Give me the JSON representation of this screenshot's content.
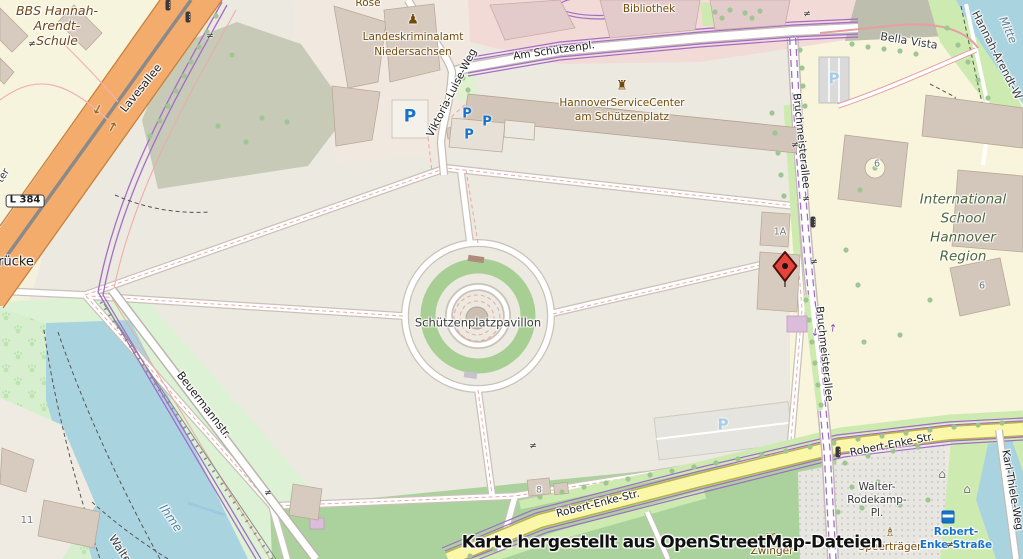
{
  "map": {
    "attribution": "Karte hergestellt aus OpenStreetMap-Dateien",
    "marker": {
      "x": 785,
      "y": 266
    },
    "colors": {
      "water": "#AAD3E0",
      "grass": "#CDEBB0",
      "park": "#DDF2D5",
      "road_orange": "#F4AC6C",
      "road_yellow": "#FBF7A9",
      "tram_purple": "#A46CC8",
      "marker_red": "#E8433A",
      "parking_blue": "#1673C9",
      "poi_brown": "#734A08"
    },
    "labels": [
      {
        "n": "poi-label-rose",
        "t": "Rose",
        "x": 368,
        "y": 3,
        "s": 10.5,
        "c": "poi"
      },
      {
        "n": "school-label-bbs-line1",
        "t": "BBS Hannah-",
        "x": 57,
        "y": 11,
        "s": 12.5,
        "c": "poi-i"
      },
      {
        "n": "school-label-bbs-line2",
        "t": "Arendt-",
        "x": 57,
        "y": 26,
        "s": 12.5,
        "c": "poi-i"
      },
      {
        "n": "school-label-bbs-line3",
        "t": "Schule",
        "x": 57,
        "y": 41,
        "s": 12.5,
        "c": "poi-i"
      },
      {
        "n": "poi-label-lka-line1",
        "t": "Landeskriminalamt",
        "x": 413,
        "y": 37,
        "s": 10.5,
        "c": "poi"
      },
      {
        "n": "poi-label-lka-line2",
        "t": "Niedersachsen",
        "x": 413,
        "y": 52,
        "s": 10.5,
        "c": "poi"
      },
      {
        "n": "poi-label-bibliothek",
        "t": "Bibliothek",
        "x": 649,
        "y": 9,
        "s": 10.5,
        "c": "poi"
      },
      {
        "n": "poi-label-servicecenter-line1",
        "t": "HannoverServiceCenter",
        "x": 622,
        "y": 103,
        "s": 10.5,
        "c": "poi"
      },
      {
        "n": "poi-label-servicecenter-line2",
        "t": "am Schützenplatz",
        "x": 622,
        "y": 117,
        "s": 10.5,
        "c": "poi"
      },
      {
        "n": "street-label-am-schuetzenpl",
        "t": "Am Schützenpl.",
        "x": 554,
        "y": 51,
        "s": 10.5,
        "c": "st",
        "r": -8
      },
      {
        "n": "street-label-lavesallee",
        "t": "Lavesallee",
        "x": 141,
        "y": 88,
        "s": 11,
        "c": "st",
        "r": -51
      },
      {
        "n": "street-label-viktoria-luise-weg",
        "t": "Viktoria-Luise-Weg",
        "x": 452,
        "y": 93,
        "s": 10.5,
        "c": "st",
        "r": -63
      },
      {
        "n": "street-label-bruchmeisterallee-north",
        "t": "Bruchmeisterallee",
        "x": 801,
        "y": 141,
        "s": 10.5,
        "c": "st",
        "r": 84
      },
      {
        "n": "street-label-bruchmeisterallee-south",
        "t": "Bruchmeisterallee",
        "x": 824,
        "y": 354,
        "s": 10.5,
        "c": "st",
        "r": 84
      },
      {
        "n": "street-label-beuermannstr",
        "t": "Beuermannstr.",
        "x": 204,
        "y": 405,
        "s": 11,
        "c": "st",
        "r": 52
      },
      {
        "n": "street-label-robert-enke-str-east",
        "t": "Robert-Enke-Str.",
        "x": 892,
        "y": 445,
        "s": 10.5,
        "c": "st",
        "r": -11
      },
      {
        "n": "street-label-robert-enke-str-west",
        "t": "Robert-Enke-Str.",
        "x": 598,
        "y": 504,
        "s": 10.5,
        "c": "st",
        "r": -14
      },
      {
        "n": "street-label-karl-thiele-weg",
        "t": "Karl-Thiele-Weg",
        "x": 1012,
        "y": 490,
        "s": 10.5,
        "c": "st",
        "r": 80
      },
      {
        "n": "path-label-bella-vista",
        "t": "Bella Vista",
        "x": 909,
        "y": 41,
        "s": 11,
        "c": "stg",
        "r": 9
      },
      {
        "n": "path-label-hannah-arendt-weg",
        "t": "Hannah-Arendt-W",
        "x": 997,
        "y": 55,
        "s": 11,
        "c": "stg",
        "r": 63
      },
      {
        "n": "street-label-fragment-ter",
        "t": "ter",
        "x": 4,
        "y": 176,
        "s": 10,
        "c": "stg",
        "r": -58
      },
      {
        "n": "bridge-label-fragment-ruecke",
        "t": "rücke",
        "x": 16,
        "y": 262,
        "s": 13,
        "c": "st"
      },
      {
        "n": "poi-label-pavillon",
        "t": "Schützenplatzpavillon",
        "x": 478,
        "y": 323,
        "s": 11.5,
        "c": "stg"
      },
      {
        "n": "school-label-intl-line1",
        "t": "International",
        "x": 963,
        "y": 200,
        "s": 13.5,
        "c": "grn"
      },
      {
        "n": "school-label-intl-line2",
        "t": "School",
        "x": 963,
        "y": 219,
        "s": 13.5,
        "c": "grn"
      },
      {
        "n": "school-label-intl-line3",
        "t": "Hannover",
        "x": 963,
        "y": 238,
        "s": 13.5,
        "c": "grn"
      },
      {
        "n": "school-label-intl-line4",
        "t": "Region",
        "x": 963,
        "y": 257,
        "s": 13.5,
        "c": "grn"
      },
      {
        "n": "district-label-mitte",
        "t": "Mitte",
        "x": 1008,
        "y": 30,
        "s": 11,
        "c": "dis",
        "r": 66
      },
      {
        "n": "water-label-ihme",
        "t": "Ihme",
        "x": 171,
        "y": 518,
        "s": 12,
        "c": "wat",
        "r": 55
      },
      {
        "n": "path-label-fragment-walte",
        "t": "Walte",
        "x": 120,
        "y": 549,
        "s": 11,
        "c": "stg",
        "r": 57
      },
      {
        "n": "square-label-walter-line1",
        "t": "Walter-",
        "x": 877,
        "y": 487,
        "s": 10.5,
        "c": "stg"
      },
      {
        "n": "square-label-walter-line2",
        "t": "Rodekamp-",
        "x": 877,
        "y": 500,
        "s": 10.5,
        "c": "stg"
      },
      {
        "n": "square-label-walter-line3",
        "t": "Pl.",
        "x": 877,
        "y": 513,
        "s": 10.5,
        "c": "stg"
      },
      {
        "n": "poi-label-speertraeger",
        "t": "Speerträger",
        "x": 890,
        "y": 547,
        "s": 10.5,
        "c": "poi"
      },
      {
        "n": "poi-label-zwinger",
        "t": "Zwinger",
        "x": 772,
        "y": 551,
        "s": 10.5,
        "c": "poi"
      },
      {
        "n": "bus-stop-label-line1",
        "t": "Robert-",
        "x": 956,
        "y": 532,
        "s": 10.5,
        "c": "bus"
      },
      {
        "n": "bus-stop-label-line2",
        "t": "Enke-Straße",
        "x": 956,
        "y": 545,
        "s": 10.5,
        "c": "bus"
      },
      {
        "n": "road-ref-l384",
        "t": "L 384",
        "x": 25,
        "y": 201,
        "s": 10,
        "c": "ref"
      },
      {
        "n": "housenumber-1a",
        "t": "1A",
        "x": 780,
        "y": 232,
        "s": 9.5,
        "c": "num"
      },
      {
        "n": "housenumber-6-north",
        "t": "6",
        "x": 877,
        "y": 164,
        "s": 9.5,
        "c": "num"
      },
      {
        "n": "housenumber-6-south",
        "t": "6",
        "x": 982,
        "y": 286,
        "s": 9.5,
        "c": "num"
      },
      {
        "n": "housenumber-8",
        "t": "8",
        "x": 539,
        "y": 491,
        "s": 9,
        "c": "num"
      },
      {
        "n": "housenumber-11",
        "t": "11",
        "x": 27,
        "y": 521,
        "s": 10,
        "c": "num"
      }
    ],
    "icons": [
      {
        "n": "parking-icon",
        "g": "P",
        "x": 410,
        "y": 117,
        "s": 17,
        "c": "#1673C9",
        "b": 1
      },
      {
        "n": "parking-icon",
        "g": "P",
        "x": 467,
        "y": 114,
        "s": 13,
        "c": "#1673C9",
        "b": 1
      },
      {
        "n": "parking-icon",
        "g": "P",
        "x": 487,
        "y": 122,
        "s": 13,
        "c": "#1673C9",
        "b": 1
      },
      {
        "n": "parking-icon",
        "g": "P",
        "x": 469,
        "y": 135,
        "s": 13,
        "c": "#1673C9",
        "b": 1
      },
      {
        "n": "parking-icon",
        "g": "P",
        "x": 834,
        "y": 79,
        "s": 15,
        "c": "#A8CCE8",
        "b": 1
      },
      {
        "n": "parking-icon",
        "g": "P",
        "x": 723,
        "y": 425,
        "s": 15,
        "c": "#A8CCE8",
        "b": 1
      },
      {
        "n": "police-icon",
        "g": "♟",
        "x": 413,
        "y": 20,
        "s": 13,
        "c": "#734A08"
      },
      {
        "n": "government-building-icon",
        "g": "♜",
        "x": 622,
        "y": 86,
        "s": 13,
        "c": "#734A08"
      },
      {
        "n": "memorial-icon",
        "g": "♗",
        "x": 890,
        "y": 532,
        "s": 12,
        "c": "#734A08"
      },
      {
        "n": "picnic-site-icon",
        "g": "♊",
        "x": 771,
        "y": 538,
        "s": 12,
        "c": "#734A08"
      },
      {
        "n": "shelter-icon",
        "g": "⌂",
        "x": 942,
        "y": 474,
        "s": 12,
        "c": "#777777"
      },
      {
        "n": "shelter-icon",
        "g": "⌂",
        "x": 967,
        "y": 489,
        "s": 12,
        "c": "#777777"
      },
      {
        "n": "traffic-signal-icon",
        "t": "signal",
        "x": 168,
        "y": 5
      },
      {
        "n": "traffic-signal-icon",
        "t": "signal",
        "x": 188,
        "y": 17
      },
      {
        "n": "traffic-signal-icon",
        "t": "signal",
        "x": 813,
        "y": 222
      },
      {
        "n": "traffic-signal-icon",
        "t": "signal",
        "x": 838,
        "y": 452
      },
      {
        "n": "bus-stop-icon",
        "t": "bus",
        "x": 948,
        "y": 517
      },
      {
        "n": "level-crossing-icon",
        "g": "≠",
        "x": 210,
        "y": 37,
        "s": 9,
        "c": "#333333"
      },
      {
        "n": "level-crossing-icon",
        "g": "≠",
        "x": 32,
        "y": 45,
        "s": 9,
        "c": "#333333"
      },
      {
        "n": "level-crossing-icon",
        "g": "≠",
        "x": 807,
        "y": 15,
        "s": 9,
        "c": "#333333"
      },
      {
        "n": "level-crossing-icon",
        "g": "≠",
        "x": 795,
        "y": 146,
        "s": 9,
        "c": "#333333"
      },
      {
        "n": "level-crossing-icon",
        "g": "≠",
        "x": 806,
        "y": 200,
        "s": 9,
        "c": "#333333"
      },
      {
        "n": "level-crossing-icon",
        "g": "≠",
        "x": 814,
        "y": 263,
        "s": 9,
        "c": "#333333"
      },
      {
        "n": "level-crossing-icon",
        "g": "≠",
        "x": 533,
        "y": 447,
        "s": 9,
        "c": "#333333"
      },
      {
        "n": "level-crossing-icon",
        "g": "≠",
        "x": 268,
        "y": 494,
        "s": 9,
        "c": "#333333"
      },
      {
        "n": "level-crossing-icon",
        "g": "≠",
        "x": 950,
        "y": 546,
        "s": 9,
        "c": "#333333"
      },
      {
        "n": "oneway-arrow-icon",
        "g": "→",
        "x": 97,
        "y": 109,
        "s": 13,
        "c": "#9A6A28",
        "r": 118,
        "b": 1
      },
      {
        "n": "oneway-arrow-icon",
        "g": "→",
        "x": 113,
        "y": 127,
        "s": 13,
        "c": "#9A6A28",
        "r": -62,
        "b": 1
      },
      {
        "n": "tram-arrow-icon",
        "g": "→",
        "x": 814,
        "y": 332,
        "s": 10,
        "c": "#7B3FA8",
        "r": 95
      },
      {
        "n": "tram-arrow-icon",
        "g": "→",
        "x": 834,
        "y": 328,
        "s": 10,
        "c": "#7B3FA8",
        "r": -85
      }
    ],
    "trees": [
      [
        216,
        16
      ],
      [
        207,
        32
      ],
      [
        199,
        47
      ],
      [
        191,
        62
      ],
      [
        184,
        76
      ],
      [
        176,
        91
      ],
      [
        168,
        106
      ],
      [
        160,
        121
      ],
      [
        150,
        136
      ],
      [
        232,
        55
      ],
      [
        262,
        118
      ],
      [
        287,
        122
      ],
      [
        218,
        126
      ],
      [
        246,
        142
      ],
      [
        463,
        78
      ],
      [
        468,
        90
      ],
      [
        715,
        12
      ],
      [
        730,
        10
      ],
      [
        745,
        13
      ],
      [
        760,
        11
      ],
      [
        722,
        18
      ],
      [
        752,
        18
      ],
      [
        772,
        113
      ],
      [
        775,
        133
      ],
      [
        778,
        153
      ],
      [
        781,
        175
      ],
      [
        784,
        196
      ],
      [
        806,
        300
      ],
      [
        809,
        320
      ],
      [
        812,
        342
      ],
      [
        815,
        363
      ],
      [
        818,
        385
      ],
      [
        821,
        405
      ],
      [
        800,
        50
      ],
      [
        802,
        68
      ],
      [
        803,
        86
      ],
      [
        805,
        106
      ],
      [
        540,
        497
      ],
      [
        562,
        492
      ],
      [
        584,
        487
      ],
      [
        606,
        483
      ],
      [
        628,
        479
      ],
      [
        650,
        475
      ],
      [
        672,
        471
      ],
      [
        694,
        467
      ],
      [
        716,
        463
      ],
      [
        738,
        459
      ],
      [
        762,
        455
      ],
      [
        786,
        451
      ],
      [
        810,
        447
      ],
      [
        834,
        443
      ],
      [
        858,
        439
      ],
      [
        882,
        436
      ],
      [
        906,
        433
      ],
      [
        930,
        430
      ],
      [
        954,
        427
      ],
      [
        978,
        425
      ],
      [
        1002,
        423
      ],
      [
        470,
        556
      ],
      [
        495,
        549
      ],
      [
        520,
        542
      ],
      [
        845,
        463
      ],
      [
        868,
        456
      ],
      [
        893,
        451
      ],
      [
        918,
        447
      ],
      [
        852,
        487
      ],
      [
        878,
        482
      ],
      [
        838,
        512
      ],
      [
        862,
        508
      ],
      [
        900,
        505
      ],
      [
        928,
        500
      ],
      [
        852,
        44
      ],
      [
        868,
        47
      ],
      [
        884,
        49
      ],
      [
        900,
        51
      ],
      [
        916,
        54
      ],
      [
        860,
        190
      ],
      [
        846,
        250
      ],
      [
        858,
        285
      ],
      [
        900,
        335
      ],
      [
        930,
        300
      ],
      [
        864,
        342
      ],
      [
        947,
        28
      ],
      [
        958,
        45
      ],
      [
        968,
        62
      ],
      [
        978,
        80
      ],
      [
        988,
        98
      ],
      [
        875,
        168
      ]
    ]
  }
}
